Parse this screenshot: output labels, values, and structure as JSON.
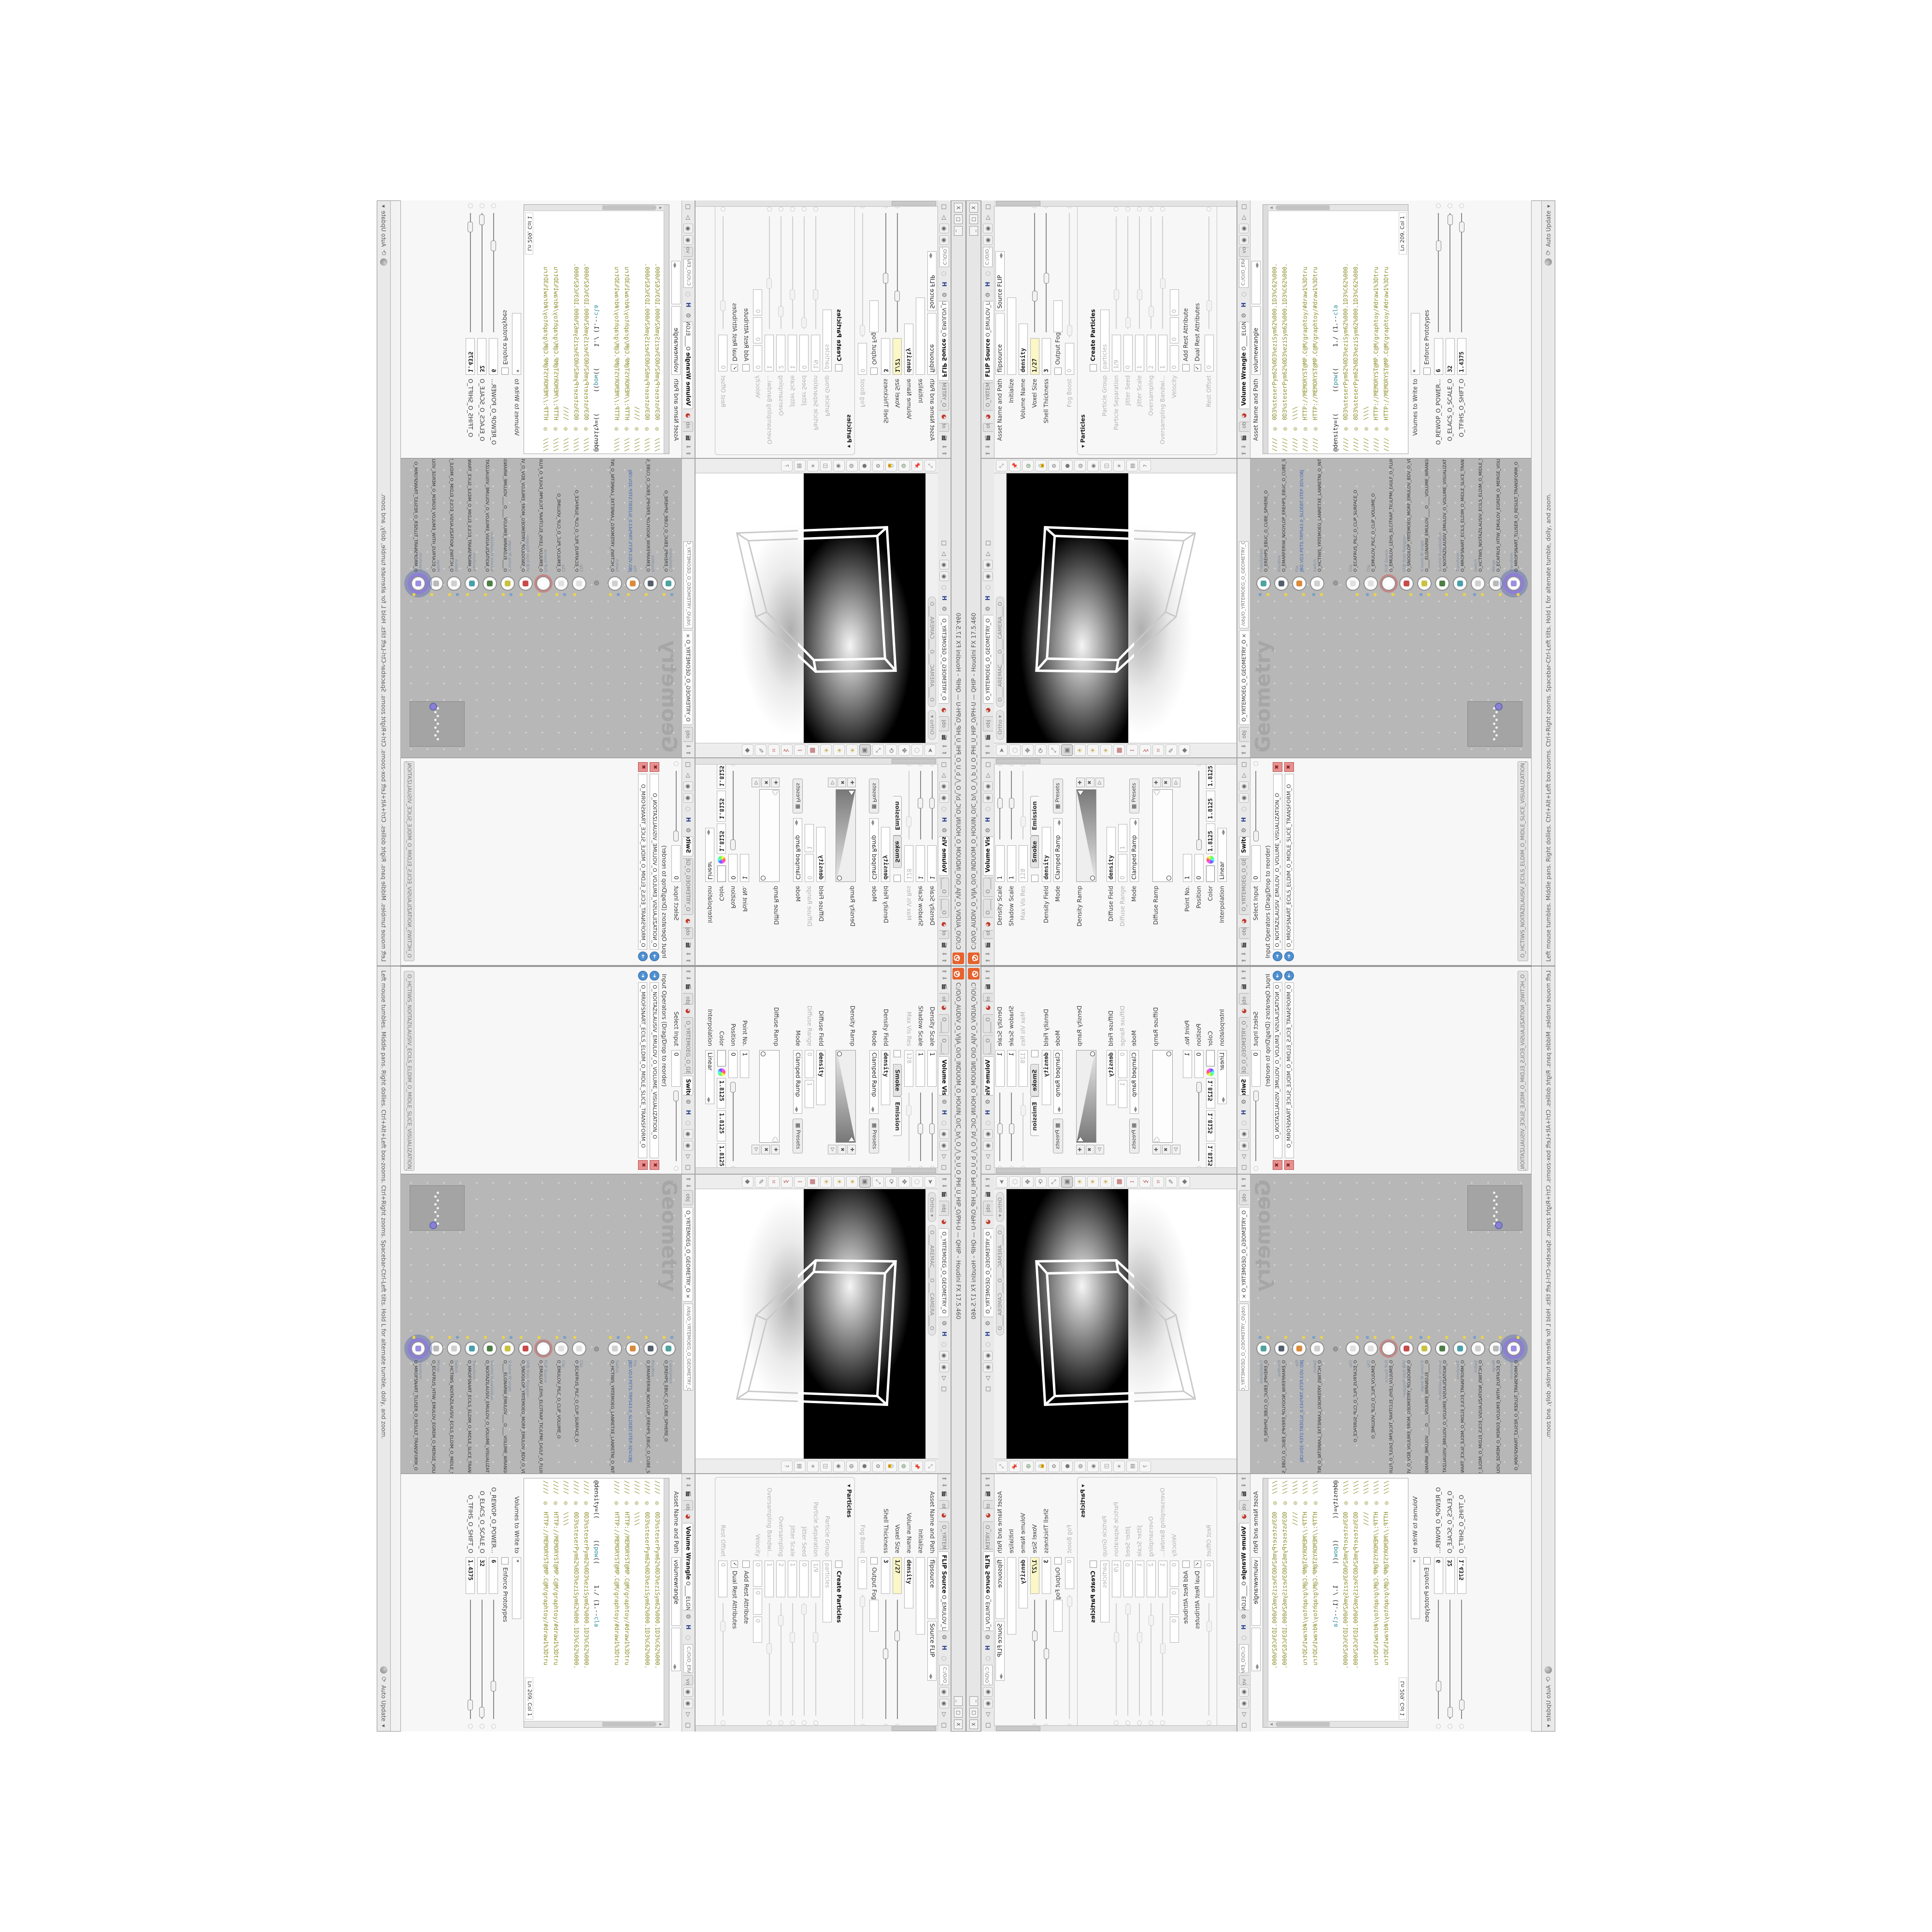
{
  "window": {
    "title": "C:/O/O_AUDIV_O_VIJA_O/O_INDUOM_O_HOUIN_O/C_b/\\_O_/\\_b_U_O_PHI_U_HIP_O/PH-U  —  QHIP – Houdini FX 17.5.460",
    "buttons": [
      "_",
      "□",
      "X"
    ],
    "logo_color": "#e8622d"
  },
  "statusbar": {
    "help": "Left mouse tumbles.  Middle pans.  Right dollies.  Ctrl+Alt+Left box-zooms.  Ctrl+Right zooms.  Spacebar-Ctrl-Left tilts.  Hold L for alternate tumble, dolly, and zoom.",
    "auto_update": "Auto Update"
  },
  "flip_pane": {
    "breadcrumb": "obj",
    "context": "O_YRTEMOEG_O_GEOMETRY_O",
    "tab_bold": "FLIP Source",
    "tab_rest": "O_EMULOV_LEHS_ELCITRAP_TICILPMI_DIULF_O_FLUID_IMPLICIT_PARTICLE_SHEL_VOLUME_O",
    "path": "C:/O/O_ERAWTFOS_O/O...",
    "rows": [
      {
        "label": "Asset Name and Path",
        "fields": [
          {
            "v": "flipsource",
            "w": 118
          },
          {
            "v": "Source FLIP",
            "w": 104,
            "dd": true
          }
        ]
      },
      {
        "label": "Initialize",
        "fields": [
          {
            "v": "",
            "w": 150
          }
        ]
      },
      {
        "label": "Volume Name",
        "fields": [
          {
            "v": "density",
            "w": 96,
            "mono": true
          }
        ]
      },
      {
        "label": "Voxel Size",
        "fields": [
          {
            "v": "1/27",
            "w": 66,
            "mono": true,
            "yellow": true
          }
        ],
        "slider": 0.3
      },
      {
        "label": "Shell Thickness",
        "fields": [
          {
            "v": "3",
            "w": 66,
            "mono": true
          }
        ],
        "slider": 0.45
      },
      {
        "check": " ",
        "chklabel": "Output Fog",
        "fields": [
          {
            "v": "",
            "w": 56
          }
        ]
      },
      {
        "label": "Fog Boost",
        "dis": true,
        "fields": [
          {
            "v": "0",
            "w": 56
          }
        ],
        "slider": 0.05
      },
      {
        "section": "Particles"
      },
      {
        "check": " ",
        "chklabel": "Create Particles",
        "bold": true
      },
      {
        "label": "Particle Group",
        "dis": true,
        "fields": [
          {
            "v": "particles",
            "w": 118
          }
        ]
      },
      {
        "label": "Particle Separation",
        "dis": true,
        "fields": [
          {
            "v": "1/9",
            "w": 66
          }
        ],
        "slider": 0.3
      },
      {
        "label": "Jitter Seed",
        "dis": true,
        "fields": [
          {
            "v": "0",
            "w": 66
          }
        ],
        "slider": 0.05
      },
      {
        "label": "Jitter Scale",
        "dis": true,
        "fields": [
          {
            "v": "1",
            "w": 66
          }
        ],
        "slider": 0.3
      },
      {
        "label": "Oversampling",
        "dis": true,
        "fields": [
          {
            "v": "2",
            "w": 66
          }
        ],
        "slider": 0.15
      },
      {
        "label": "Oversampling Bandwi...",
        "dis": true,
        "fields": [
          {
            "v": "1",
            "w": 66
          }
        ],
        "slider": 0.4
      },
      {
        "label": "Velocity",
        "dis": true,
        "fields": [
          {
            "v": "0",
            "w": 44
          },
          {
            "v": "0",
            "w": 44
          },
          {
            "v": "0",
            "w": 44
          }
        ]
      },
      {
        "check": " ",
        "chklabel": "Add Rest Attribute",
        "dis": true
      },
      {
        "check": "✓",
        "chklabel": "Dual Rest Attributes",
        "dis": true
      },
      {
        "label": "Rest Offset",
        "dis": true,
        "fields": [
          {
            "v": "0",
            "w": 66
          }
        ],
        "slider": 0.2
      }
    ]
  },
  "wrangle_pane": {
    "breadcrumb": "obj",
    "tab_bold": "Volume Wrangle",
    "tab_rest": "O____ELGNARW_EMULOV____O____VOLUME_WRANGL...",
    "path": "C:/O/O_ERAWTFOS_O/O...",
    "vol_tab": "vol",
    "asset_row": {
      "label": "Asset Name and Path",
      "fields": [
        {
          "v": "volumewrangle",
          "w": 132
        },
        {
          "v": "",
          "w": 70,
          "dd": true
        }
      ]
    },
    "code_lines": [
      {
        "t": "comment",
        "text": "////  ◎  0D3%steserPym62%0D3%eziSym62%000.1D3%C62%000."
      },
      {
        "t": "comment",
        "text": "////  ◎  0D3%steserPym62%0D3%eziSym62%000.1D3%C62%000."
      },
      {
        "t": "comment",
        "text": "////  ◎  \\\\\\\\"
      },
      {
        "t": "comment",
        "text": "////  ◎  HTTP://MEMORYST@MP.C@M/graphtoy/#draw1%3Dtru"
      },
      {
        "t": "comment",
        "text": "////  ◎  HTTP://MEMORYST@MP.C@M/graphtoy/#draw1%3Dtru"
      },
      {
        "t": "blank",
        "text": ""
      },
      {
        "t": "code",
        "segs": [
          {
            "s": "@density=((      (("
          },
          {
            "s": "pow",
            "k": true
          },
          {
            "s": "((      1./ (1.--"
          },
          {
            "s": "cla",
            "k": true
          }
        ]
      },
      {
        "t": "comment",
        "text": "////  ◎  0D3%steserPym62%0D3%eziSym62%000.1D3%C62%000."
      },
      {
        "t": "comment",
        "text": "////  ◎  0D3%steserPym62%0D3%eziSym62%000.1D3%C62%000."
      },
      {
        "t": "comment",
        "text": "////  ◎  \\\\\\\\"
      },
      {
        "t": "comment",
        "text": "////  ◎  HTTP://MEMORYST@MP.C@M/graphtoy/#draw1%3Dtru"
      },
      {
        "t": "comment",
        "text": "////  ◎  HTTP://MEMORYST@MP.C@M/graphtoy/#draw1%3Dtru"
      }
    ],
    "line_col": "Ln 209, Col 1",
    "rows": [
      {
        "label": "Volumes to Write to",
        "fields": [
          {
            "v": "*",
            "w": 118
          }
        ]
      },
      {
        "check": " ",
        "chklabel": "Enforce Prototypes"
      },
      {
        "label": "O_REWOP_O_POWER...",
        "fields": [
          {
            "v": "6",
            "w": 66,
            "mono": true
          }
        ],
        "slider": 0.72
      },
      {
        "label": "O_ELACS_O_SCALE_O",
        "fields": [
          {
            "v": "32",
            "w": 66,
            "mono": true
          }
        ],
        "slider": 0.94
      },
      {
        "label": "O_TFIHS_O_SHIFT_O",
        "fields": [
          {
            "v": "1.4375",
            "w": 66,
            "mono": true
          }
        ],
        "slider": 0.88
      }
    ]
  },
  "volviz_pane": {
    "breadcrumb": "obj",
    "context": "O_YRTEMOEG_O_GEOMETRY_O",
    "extra_tabs": [
      "O____ARTNAM___O...",
      "O____AREMAC___O..."
    ],
    "tab_bold": "Volume Visualization",
    "tab_rest": "O_NOITAZILAUSIV_EMULOV_O_VO",
    "rows": [
      {
        "label": "Density Scale",
        "fields": [
          {
            "v": "1",
            "w": 66
          }
        ],
        "slider": 0.52
      },
      {
        "label": "Shadow Scale",
        "fields": [
          {
            "v": "1",
            "w": 66
          }
        ],
        "slider": 0.52
      },
      {
        "label": "Max Vis Res",
        "dis": true,
        "fields": [
          {
            "v": "128",
            "w": 66
          }
        ],
        "slider": 0.25
      },
      {
        "check": " ",
        "tabs": [
          "Smoke",
          "Emission"
        ],
        "active_tab": 1
      },
      {
        "label": "Density Field",
        "fields": [
          {
            "v": "density",
            "w": 104,
            "mono": true
          }
        ]
      },
      {
        "label": "Mode",
        "fields": [
          {
            "v": "Clamped Ramp",
            "w": 112,
            "dd": true
          }
        ],
        "button": "Presets"
      },
      {
        "ramp": "Density Ramp"
      },
      {
        "label": "Diffuse Field",
        "fields": [
          {
            "v": "density",
            "w": 104,
            "mono": true
          }
        ]
      },
      {
        "label": "Diffuse Range",
        "dis": true,
        "fields": [
          {
            "v": "0",
            "w": 48
          },
          {
            "v": "1",
            "w": 48
          }
        ]
      },
      {
        "label": "Mode",
        "fields": [
          {
            "v": "Clamped Ramp",
            "w": 112,
            "dd": true
          }
        ],
        "button": "Presets"
      },
      {
        "ramp": "Diffuse Ramp",
        "flat": true
      },
      {
        "label": "Point No.",
        "fields": [
          {
            "v": "1",
            "w": 48
          }
        ]
      },
      {
        "label": "Position",
        "fields": [
          {
            "v": "0",
            "w": 48
          }
        ],
        "slider": 0.04
      },
      {
        "color_row": true,
        "label": "Color",
        "values": [
          "1.8125",
          "1.8125",
          "1.8125"
        ]
      },
      {
        "label": "Interpolation",
        "fields": [
          {
            "v": "Linear",
            "w": 92,
            "dd": true
          }
        ]
      }
    ]
  },
  "switch_pane": {
    "breadcrumb": "obj",
    "context": "O_YRTEMOEG_O_GEOMETRY_O",
    "tab_bold": "Switch",
    "tab_rest": "O_HCTIWS_NOITAZILAUSIV_ECILS_ELDIM_O_MIDLE_SLICE_VISUALIZATION_SWITCH_O",
    "rows_top": [
      {
        "label": "Select Input",
        "fields": [
          {
            "v": "0",
            "w": 66
          }
        ],
        "slider": 0.04
      }
    ],
    "oplist_label": "Input Operators (Drag/Drop to reorder)",
    "operators": [
      "O_NOITAZILAUSIV_EMULOV_O_VOLUME_VISUALIZATION_O",
      "O_MROFSNART_ECILS_ELDIM_O_MIDLE_SLICE_TRANSFORM_O"
    ]
  },
  "viewport_pane": {
    "breadcrumb": "obj",
    "tab": "O_YRTEMOEG_O_GEOMETRY_O",
    "ortho_pill": "Ortho ▾",
    "camera_pill": "O____AREMAC____O____CAMERA____O",
    "left_icons": [
      "select-arrow-icon",
      "lasso-icon",
      "move-icon",
      "rotate-icon",
      "scale-icon",
      "camera-frame-icon",
      "lamp-a-icon",
      "lamp-b-icon",
      "lamp-c-icon",
      "snap-grid-icon",
      "snap-point-icon",
      "snap-edge-icon",
      "snap-prim-icon",
      "brush-icon",
      "eraser-icon"
    ],
    "right_icons": [
      "expand-icon",
      "pin-icon",
      "globe-icon",
      "lock-icon",
      "gear-icon",
      "sphere-shade-icon",
      "sphere-wire-icon",
      "eye-icon",
      "cube-icon",
      "light-icon",
      "camera2-icon",
      "help-icon"
    ]
  },
  "network_pane": {
    "breadcrumb_path": "/obj/O_YRTEMOEG_O_GEOMETRY_O",
    "tab": "O_YRTEMOEG_O_GEOMETRY_O",
    "watermark": "Geometry",
    "nodes": [
      {
        "type": "CubeSphere",
        "name": "O_EREHPS_EBUC_O_CUBE_SPHERE_O",
        "color": "#4fa3a0"
      },
      {
        "type": "PolyWire",
        "name": "O_EMARFERIW_NOGYLOP_EREHPS_EBUC_O_CUBE_SPHERE_POLYGON_WIREFRAME_O",
        "color": "#55606e"
      },
      {
        "type": "File",
        "name": "JBD.VD3.PETS.TRPS43.0_SLDEBT.STEP-3DV.OBJ",
        "color": "#d98a3a",
        "blue_label": true
      },
      {
        "type": "Switch",
        "name": "O_HCTIWS_YRTEMOEG_LANRETXE_LANRETNI_O_INTERNAL_EXTERNAL_GEOMETRY_SWITCH_O",
        "color": "#cfcfcf"
      },
      {
        "type": "dot",
        "name": "",
        "color": "#9a9a9a"
      },
      {
        "type": "Clip",
        "name": "O_ECAFRUS_PILC_O_CLIP_SURFACE_O",
        "color": "#e0e0e0"
      },
      {
        "type": "Clip",
        "name": "O_EMULOV_PILC_O_CLIP_VOLUME_O",
        "color": "#e0e0e0"
      },
      {
        "type": "FLIP Source",
        "name": "O_EMULOV_LEHS_ELCITRAP_TICILPMI_DIULF_O_FLUID_IMPLICIT_PARTICLE_SHEL_VOL...",
        "color": "#ffffff",
        "ring": true
      },
      {
        "type": "VDB from Polygons",
        "name": "O_SNOGILOP_YRTEMOEG_MORF_EMULOV_BDV_O_VDB_VOLUME_FROM_GEOMETRY_POLYG...",
        "color": "#c84b4b"
      },
      {
        "type": "Volume Wrangle",
        "name": "O____ELGNARW_EMULOV____O____VOLUME_WRANGLE____O",
        "color": "#c8c23e"
      },
      {
        "type": "Volume Visualization",
        "name": "O_NOITAZILAUSIV_EMULOV_O_VOLUME_VISUALIZATION_O",
        "color": "#4e7d46"
      },
      {
        "type": "Transform",
        "name": "O_MROFSNART_ECILS_ELDIM_O_MIDLE_SLICE_TRANSFORM_O",
        "color": "#49a0ac"
      },
      {
        "type": "Switch",
        "name": "O_HCTIWS_NOITAZILAUSIV_ECILS_ELDIM_O_MIDLE_SLICE_VISUALIZATION_SWITCH_O",
        "color": "#cfcfcf"
      },
      {
        "type": "Merge",
        "name": "O_ECAFRUS_HTIW_EMULOV_EGREM_O_MERGE_VOLUME_WITH_SURFACE_O",
        "color": "#b9b9b9"
      },
      {
        "type": "Transform",
        "name": "O_MROFSNART_TLUSER_O_RESULT_TRANSFORM_O",
        "color": "#9a8fe0",
        "selected": true
      }
    ]
  }
}
